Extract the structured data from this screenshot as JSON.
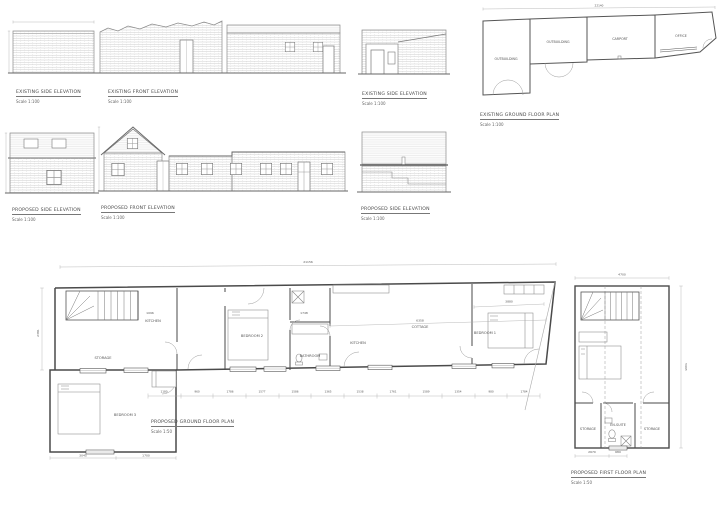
{
  "sheet": {
    "background": "#ffffff",
    "ink": "#555555",
    "wall_color": "#4a4a4a",
    "hatch_color": "#c8c8c8"
  },
  "captions": {
    "existing_side_1": {
      "title": "EXISTING SIDE ELEVATION",
      "scale": "Scale 1:100"
    },
    "existing_front": {
      "title": "EXISTING FRONT ELEVATION",
      "scale": "Scale 1:100"
    },
    "existing_side_2": {
      "title": "EXISTING SIDE ELEVATION",
      "scale": "Scale 1:100"
    },
    "existing_gf_plan": {
      "title": "EXISTING GROUND FLOOR PLAN",
      "scale": "Scale 1:100"
    },
    "proposed_side_1": {
      "title": "PROPOSED SIDE ELEVATION",
      "scale": "Scale 1:100"
    },
    "proposed_front": {
      "title": "PROPOSED FRONT ELEVATION",
      "scale": "Scale 1:100"
    },
    "proposed_side_2": {
      "title": "PROPOSED SIDE ELEVATION",
      "scale": "Scale 1:100"
    },
    "proposed_gf_plan": {
      "title": "PROPOSED GROUND FLOOR PLAN",
      "scale": "Scale 1:50"
    },
    "proposed_ff_plan": {
      "title": "PROPOSED FIRST FLOOR PLAN",
      "scale": "Scale 1:50"
    }
  },
  "existing_plan": {
    "rooms": {
      "outbuilding_1": "OUTBUILDING",
      "outbuilding_2": "OUTBUILDING",
      "carport": "CARPORT",
      "office": "OFFICE"
    },
    "dim_overall": "22140"
  },
  "ground_plan": {
    "rooms": {
      "kitchen_top": "KITCHEN",
      "storage": "STORAGE",
      "bedroom3": "BEDROOM 3",
      "bedroom2": "BEDROOM 2",
      "bathroom": "BATHROOM",
      "kitchen": "KITCHEN",
      "cottage": "COTTAGE",
      "bedroom1": "BEDROOM 1"
    },
    "dims": {
      "overall": "21156",
      "hall": "6358",
      "bed1": "3880",
      "kitchen": "1096",
      "shower": "1748",
      "wing_a": "3045",
      "wing_b": "1700",
      "side": "2381",
      "chain": [
        "1180",
        "960",
        "1786",
        "1577",
        "1586",
        "1365",
        "1538",
        "1761",
        "1589",
        "1354",
        "980",
        "1784"
      ]
    }
  },
  "first_floor_plan": {
    "rooms": {
      "storage_l": "STORAGE",
      "ensuite": "EN-SUITE",
      "storage_r": "STORAGE"
    },
    "dims": {
      "overall": "4700",
      "depth": "5665",
      "a": "2670",
      "b": "680"
    }
  }
}
